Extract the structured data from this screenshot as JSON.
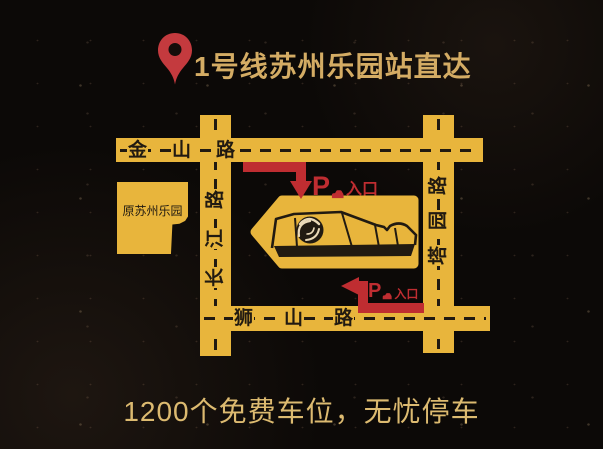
{
  "header": {
    "title": "1号线苏州乐园站直达"
  },
  "footer": {
    "caption": "1200个免费车位，无忧停车"
  },
  "map": {
    "roads": {
      "jinshan": {
        "label": "金山路",
        "orientation": "horizontal"
      },
      "shishan": {
        "label": "狮山路",
        "orientation": "horizontal"
      },
      "changjiang": {
        "label": "长江路",
        "orientation": "vertical"
      },
      "tayuan": {
        "label": "塔园路",
        "orientation": "vertical"
      }
    },
    "landmark": {
      "label": "原苏州乐园"
    },
    "entrances": {
      "north": {
        "symbol": "P",
        "label": "入口"
      },
      "south": {
        "symbol": "P",
        "label": "入口"
      }
    },
    "icons": {
      "pin": "map-pin-icon",
      "car": "car-icon",
      "venue_logo": "swirl-logo-icon"
    }
  },
  "colors": {
    "background": "#0c0907",
    "road_yellow": "#e8b53c",
    "arrow_red": "#bf2d31",
    "pin_red": "#c43a3e",
    "title_gold": "#d4ac64",
    "caption_gold": "#dcba70",
    "ink": "#211a11"
  }
}
